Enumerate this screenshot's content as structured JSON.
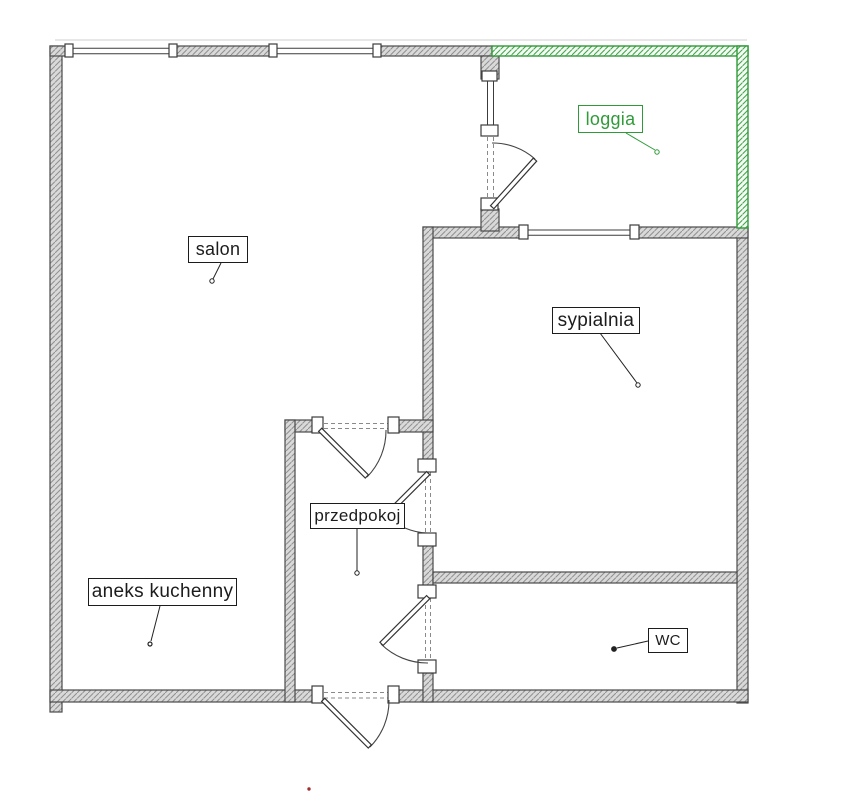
{
  "plan": {
    "type": "apartment-floor-plan",
    "rooms": {
      "salon": {
        "label": "salon"
      },
      "loggia": {
        "label": "loggia"
      },
      "sypialnia": {
        "label": "sypialnia"
      },
      "przedpokoj": {
        "label": "przedpokoj"
      },
      "aneks_kuchenny": {
        "label": "aneks kuchenny"
      },
      "wc": {
        "label": "WC"
      }
    },
    "colors": {
      "wall_fill": "#d9d9d9",
      "wall_hatch": "#8f8f8f",
      "wall_outline": "#4a4a4a",
      "loggia_accent": "#2f9b38",
      "marker_dot": "#a03030",
      "background": "#ffffff"
    }
  }
}
